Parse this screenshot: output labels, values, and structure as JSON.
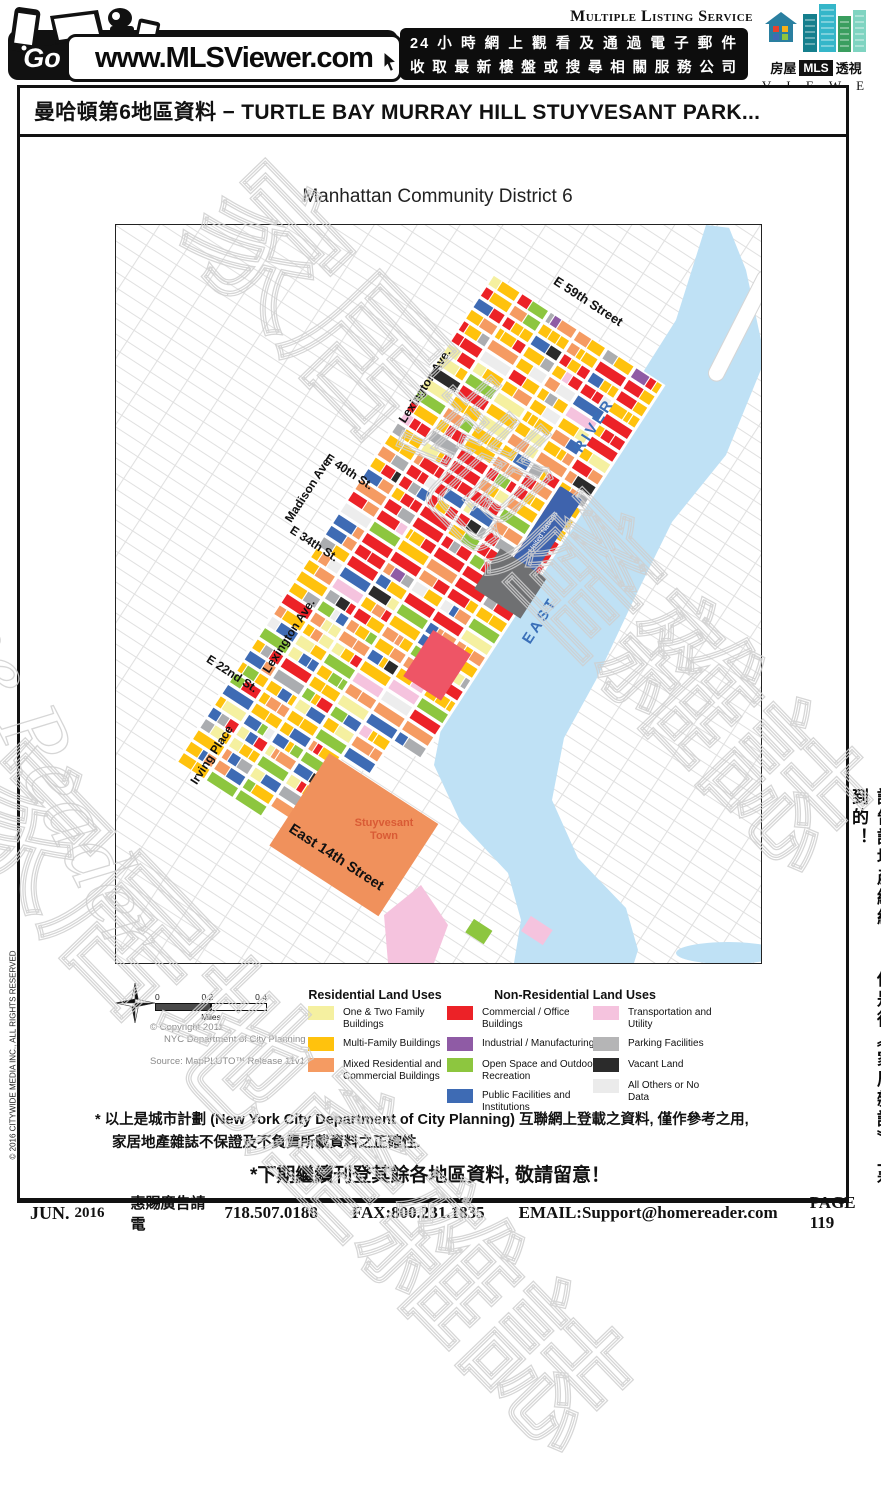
{
  "header": {
    "go_label": "Go",
    "url": "www.MLSViewer.com",
    "tagline_line1": "24小時網上觀看及通過電子郵件",
    "tagline_line2": "收取最新樓盤或搜尋相關服務公司",
    "mls_service": "Multiple Listing Service",
    "logo": {
      "left_cn": "房屋",
      "mls": "MLS",
      "right_cn": "透視",
      "viewer": "V I E W E R"
    }
  },
  "title_bar": {
    "text": "曼哈頓第6地區資料  −  TURTLE BAY MURRAY HILL STUYVESANT PARK..."
  },
  "map": {
    "title": "Manhattan Community District 6",
    "street_labels": [
      "E 59th Street",
      "E 40th St.",
      "E 34th  St.",
      "E 22nd St.",
      "East 14th Street"
    ],
    "avenue_labels": [
      "Lexington Ave.",
      "Madison Ave.",
      "Lexington Ave.",
      "Irving Place"
    ],
    "area_labels": {
      "united_nations": "United Nations",
      "stuyvesant_line1": "Stuyvesant",
      "stuyvesant_line2": "Town",
      "east": "EAST",
      "river": "RIVER"
    },
    "scale": {
      "t0": "0",
      "t1": "0.2",
      "t2": "0.4",
      "unit": "Miles"
    },
    "credits": {
      "line1": "© Copyright 2011",
      "line2": "NYC Department of City Planning",
      "source": "Source: MapPLUTO™ Release 11v1"
    }
  },
  "legend": {
    "residential": {
      "title": "Residential Land Uses",
      "items": [
        {
          "label": "One & Two Family Buildings",
          "color": "#F5F0A0"
        },
        {
          "label": "Multi-Family Buildings",
          "color": "#FFC20D"
        },
        {
          "label": "Mixed Residential and Commercial Buildings",
          "color": "#F59B62"
        }
      ]
    },
    "non_residential": {
      "title": "Non-Residential Land Uses",
      "col1": [
        {
          "label": "Commercial / Office Buildings",
          "color": "#EC2227"
        },
        {
          "label": "Industrial / Manufacturing",
          "color": "#8F5BA5"
        },
        {
          "label": "Open Space and Outdoor Recreation",
          "color": "#8DC63F"
        },
        {
          "label": "Public Facilities and Institutions",
          "color": "#3E6BB4"
        }
      ],
      "col2": [
        {
          "label": "Transportation and Utility",
          "color": "#F5C3DE"
        },
        {
          "label": "Parking Facilities",
          "color": "#B5B5B6"
        },
        {
          "label": "Vacant Land",
          "color": "#2B2B2B"
        },
        {
          "label": "All Others or No Data",
          "color": "#EBEBEB"
        }
      ]
    }
  },
  "map_palette": {
    "gold": "#FFC20D",
    "red": "#EC2227",
    "orange": "#F59B62",
    "pale": "#F5F0A0",
    "blue": "#3E6BB4",
    "green": "#8DC63F",
    "pink": "#F5C3DE",
    "gray": "#ABADB0",
    "dark": "#2B2B2B",
    "purple": "#8F5BA5",
    "light": "#EDEDED",
    "river": "#BFE1F5",
    "river_text": "#3A6FB8",
    "un_blue": "#3E63AD",
    "stuy_fill": "#F0915C",
    "stuy_text": "#D95B35",
    "grid_line": "#E0E0E0"
  },
  "footnotes": {
    "line1": "* 以上是城市計劃 (New York City Department of City Planning) 互聯網上登載之資料, 僅作參考之用,",
    "line2": "家居地產雜誌不保證及不負責所載資料之正確性.",
    "notice": "*下期繼續刊登其餘各地區資料, 敬請留意！"
  },
  "footer": {
    "month": "JUN.",
    "year": "2016",
    "ad_text": "惠賜廣告請電",
    "phone": "718.507.0188",
    "fax": "FAX:800.231.1835",
    "email": "EMAIL:Support@homereader.com",
    "page": "PAGE 119"
  },
  "side_texts": {
    "left": "© 2016 CITYWIDE MEDIA INC., ALL RIGHTS RESERVED",
    "right": "請告訴地產經紀： 你是從《家居雜誌》上看到的！"
  },
  "watermark": {
    "english": "Home Reader",
    "chinese": "家居地產雜誌"
  }
}
